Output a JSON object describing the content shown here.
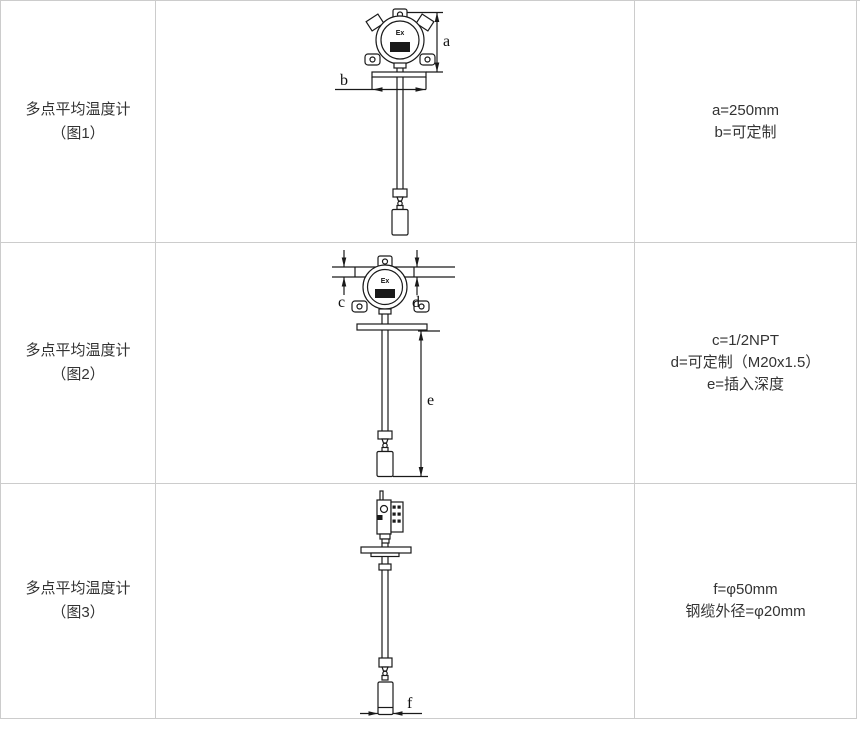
{
  "table": {
    "border_color": "#cccccc",
    "background": "#ffffff",
    "text_color": "#333333"
  },
  "rows": [
    {
      "title": "多点平均温度计",
      "figure_ref": "（图1）",
      "dims": [
        "a=250mm",
        "b=可定制"
      ],
      "diagram": {
        "ex_label": "Ex",
        "labels": {
          "a": "a",
          "b": "b"
        }
      }
    },
    {
      "title": "多点平均温度计",
      "figure_ref": "（图2）",
      "dims": [
        "c=1/2NPT",
        "d=可定制（M20x1.5）",
        "e=插入深度"
      ],
      "diagram": {
        "ex_label": "Ex",
        "labels": {
          "c": "c",
          "d": "d",
          "e": "e"
        }
      }
    },
    {
      "title": "多点平均温度计",
      "figure_ref": "（图3）",
      "dims": [
        "f=φ50mm",
        "钢缆外径=φ20mm"
      ],
      "diagram": {
        "labels": {
          "f": "f"
        }
      }
    }
  ]
}
